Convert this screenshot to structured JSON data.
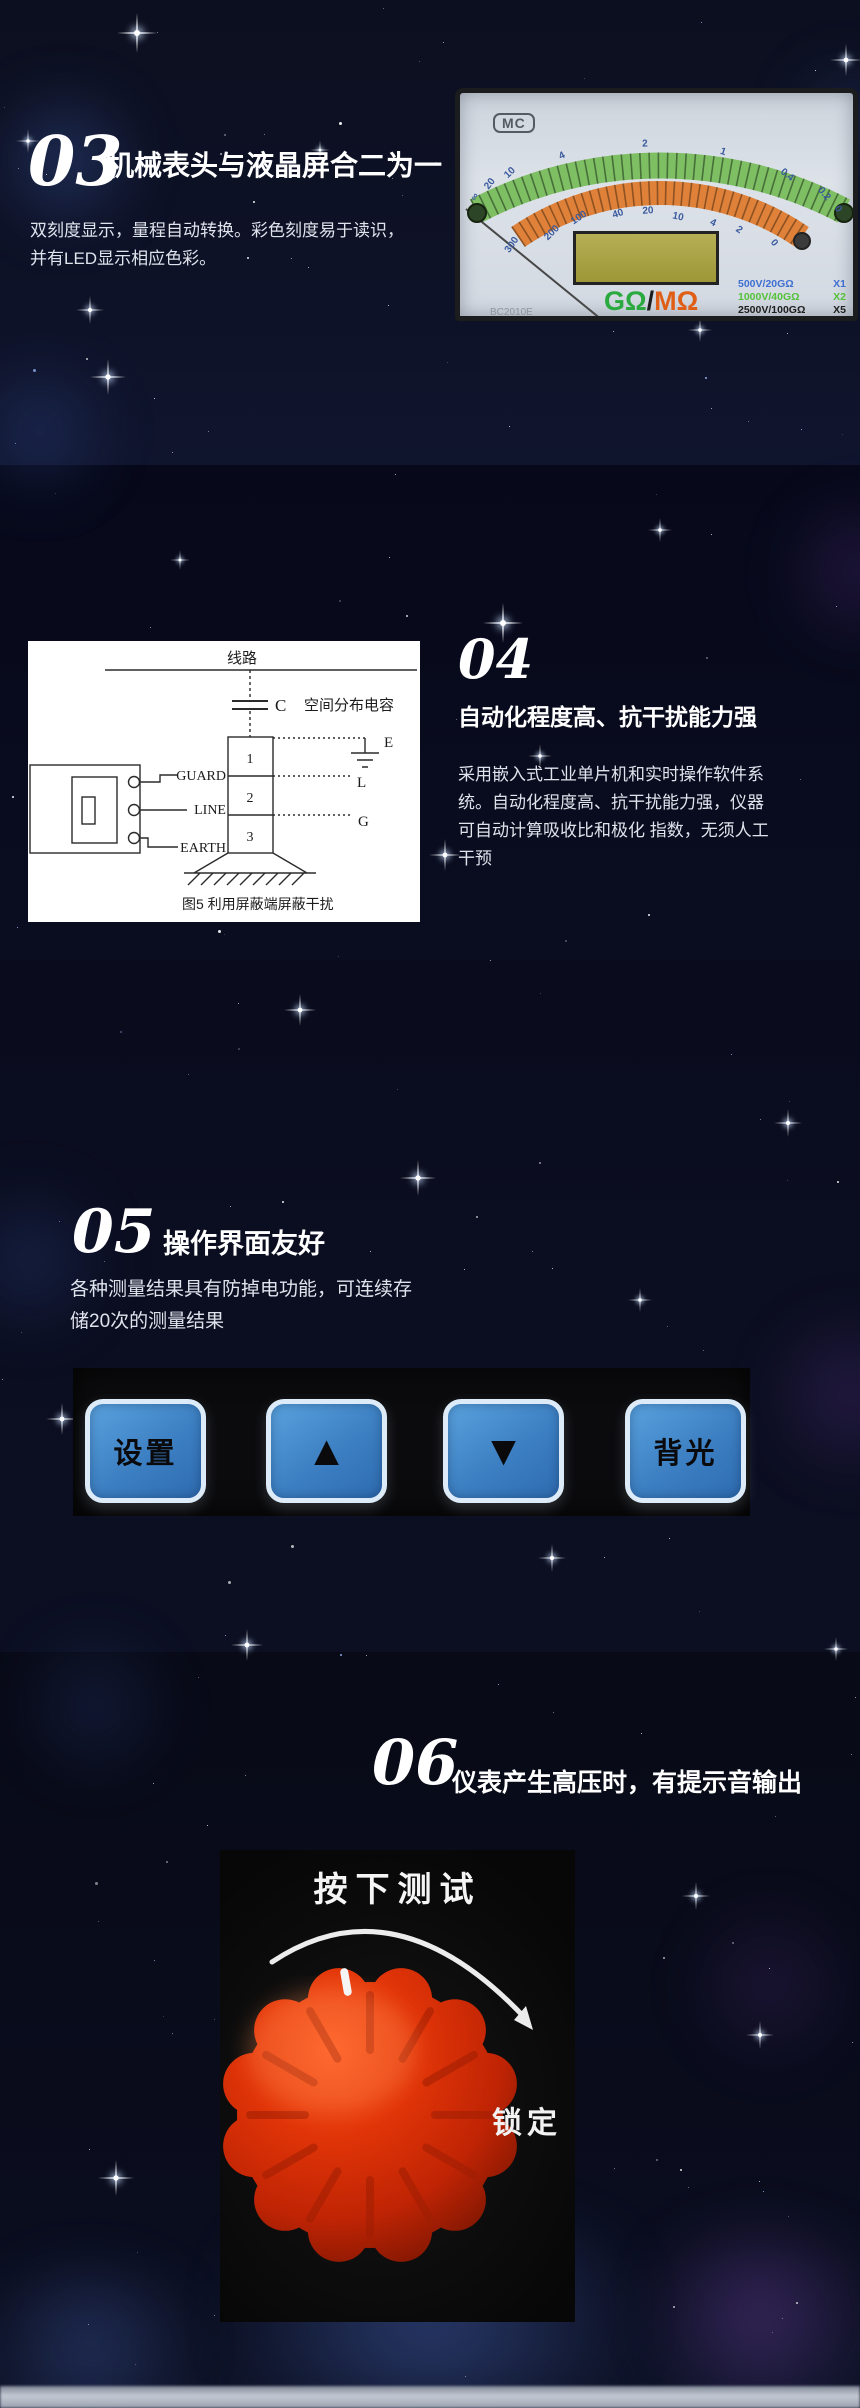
{
  "section03": {
    "number": "03",
    "title": "机械表头与液晶屏合二为一",
    "body": [
      "双刻度显示，量程自动转换。彩色刻度易于读识，",
      "并有LED显示相应色彩。"
    ],
    "meter": {
      "logo": "MC",
      "scale_green": [
        "∞",
        "20",
        "10",
        "4",
        "2",
        "1",
        "0.4",
        "0.2",
        "0"
      ],
      "scale_orange": [
        "300",
        "200",
        "100",
        "40",
        "20",
        "10",
        "4",
        "2",
        "0"
      ],
      "unit": {
        "g": "GΩ",
        "slash": "/",
        "m": "MΩ"
      },
      "ranges": [
        {
          "label": "500V/20GΩ",
          "mult": "X1",
          "color": "#3f6fd1"
        },
        {
          "label": "1000V/40GΩ",
          "mult": "X2",
          "color": "#55c23a"
        },
        {
          "label": "2500V/100GΩ",
          "mult": "X5",
          "color": "#1d1d1d"
        },
        {
          "label": "5000V/200GΩ",
          "mult": "X10",
          "color": "#7c7c2e"
        }
      ],
      "model": "BC2010E",
      "bottom_label": "4GΩ-4000MΩ",
      "green_band_color": "#7fbf63",
      "orange_band_color": "#e0813a"
    }
  },
  "section04": {
    "number": "04",
    "title": "自动化程度高、抗干扰能力强",
    "body": [
      "采用嵌入式工业单片机和实时操作软件系",
      "统。自动化程度高、抗干扰能力强，仪器",
      "可自动计算吸收比和极化 指数，无须人工",
      "干预"
    ],
    "diagram": {
      "line_label": "线路",
      "cap_label": "C",
      "cap_note": "空间分布电容",
      "terminals": [
        "GUARD",
        "LINE",
        "EARTH"
      ],
      "cells": [
        "1",
        "2",
        "3"
      ],
      "right_labels": [
        "E",
        "L",
        "G"
      ],
      "caption": "图5  利用屏蔽端屏蔽干扰"
    }
  },
  "section05": {
    "number": "05",
    "title": "操作界面友好",
    "body": [
      "各种测量结果具有防掉电功能，可连续存",
      "储20次的测量结果"
    ],
    "buttons": [
      {
        "label": "设置"
      },
      {
        "label": "▲"
      },
      {
        "label": "▼"
      },
      {
        "label": "背光"
      }
    ],
    "button_color": "#3c7fc2"
  },
  "section06": {
    "number": "06",
    "title": "仪表产生高压时，有提示音输出",
    "knob": {
      "top_label": "按下测试",
      "side_label": "锁定",
      "color": "#d22c08"
    }
  }
}
